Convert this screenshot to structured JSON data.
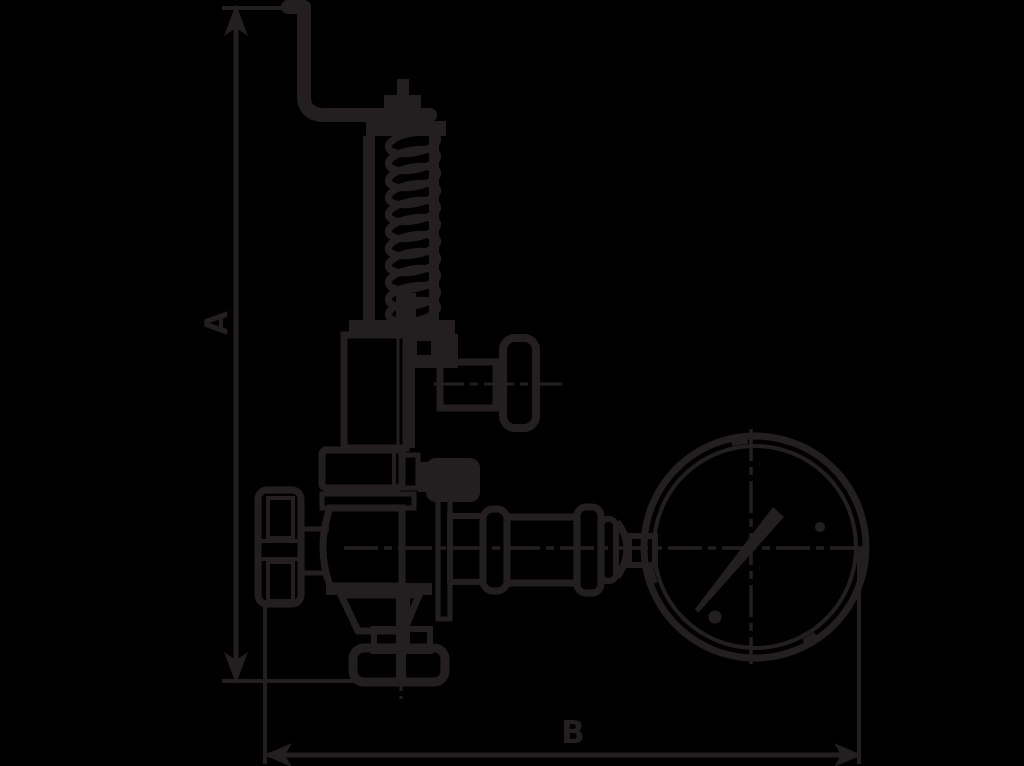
{
  "colors": {
    "background": "#000000",
    "ink": "#231f20"
  },
  "drawing": {
    "kind": "technical-dimension-diagram",
    "subject": "safety relief valve with test lever, coil spring and pressure gauge",
    "dimension_labels": {
      "a": "A",
      "b": "B"
    },
    "parts": [
      "test-lever",
      "stem-nut",
      "spring-yoke",
      "coil-spring",
      "bonnet-tube",
      "discharge-outlet",
      "union-nut",
      "handwheel",
      "valve-body",
      "inlet-flange",
      "gauge-connection",
      "pressure-gauge",
      "gauge-needle"
    ]
  }
}
